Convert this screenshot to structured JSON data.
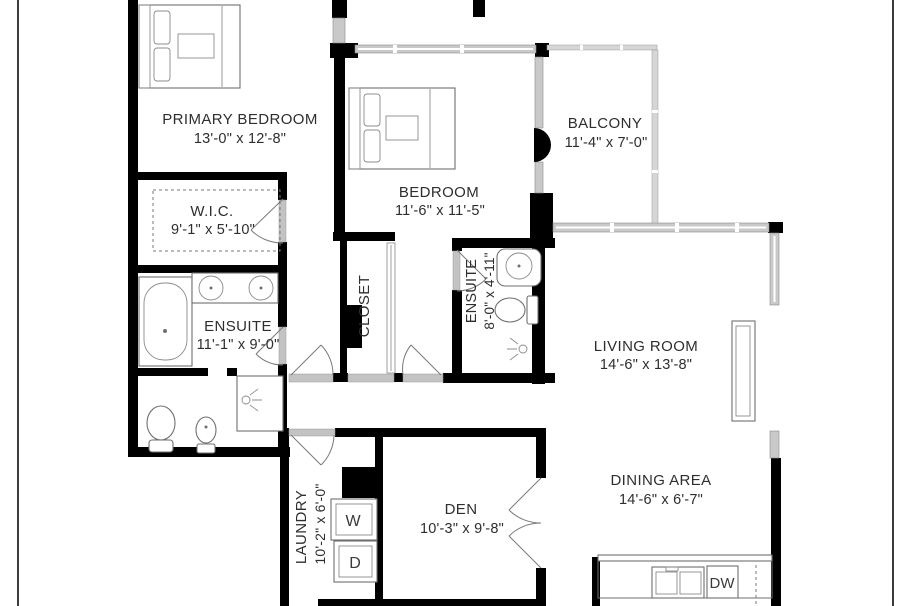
{
  "plan_title": "apartment-floor-plan",
  "rooms": {
    "primary_bedroom": {
      "name": "PRIMARY BEDROOM",
      "dims": "13'-0\" x 12'-8\""
    },
    "wic": {
      "name": "W.I.C.",
      "dims": "9'-1\" x 5'-10\""
    },
    "primary_ensuite": {
      "name": "ENSUITE",
      "dims": "11'-1\" x 9'-0\""
    },
    "bedroom": {
      "name": "BEDROOM",
      "dims": "11'-6\" x 11'-5\""
    },
    "closet": {
      "name": "CLOSET"
    },
    "ensuite2": {
      "name": "ENSUITE",
      "dims": "8'-0\" x 4'-11\""
    },
    "balcony": {
      "name": "BALCONY",
      "dims": "11'-4\" x 7'-0\""
    },
    "living_room": {
      "name": "LIVING ROOM",
      "dims": "14'-6\" x 13'-8\""
    },
    "dining_area": {
      "name": "DINING AREA",
      "dims": "14'-6\" x 6'-7\""
    },
    "den": {
      "name": "DEN",
      "dims": "10'-3\" x 9'-8\""
    },
    "laundry": {
      "name": "LAUNDRY",
      "dims": "10'-2\" x 6'-0\""
    }
  },
  "appliances": {
    "washer": "W",
    "dryer": "D",
    "dishwasher": "DW",
    "fireplace": "FP"
  },
  "colors": {
    "wall": "#000000",
    "window": "#c9c9c9",
    "background": "#ffffff",
    "text": "#2e2e2e"
  }
}
